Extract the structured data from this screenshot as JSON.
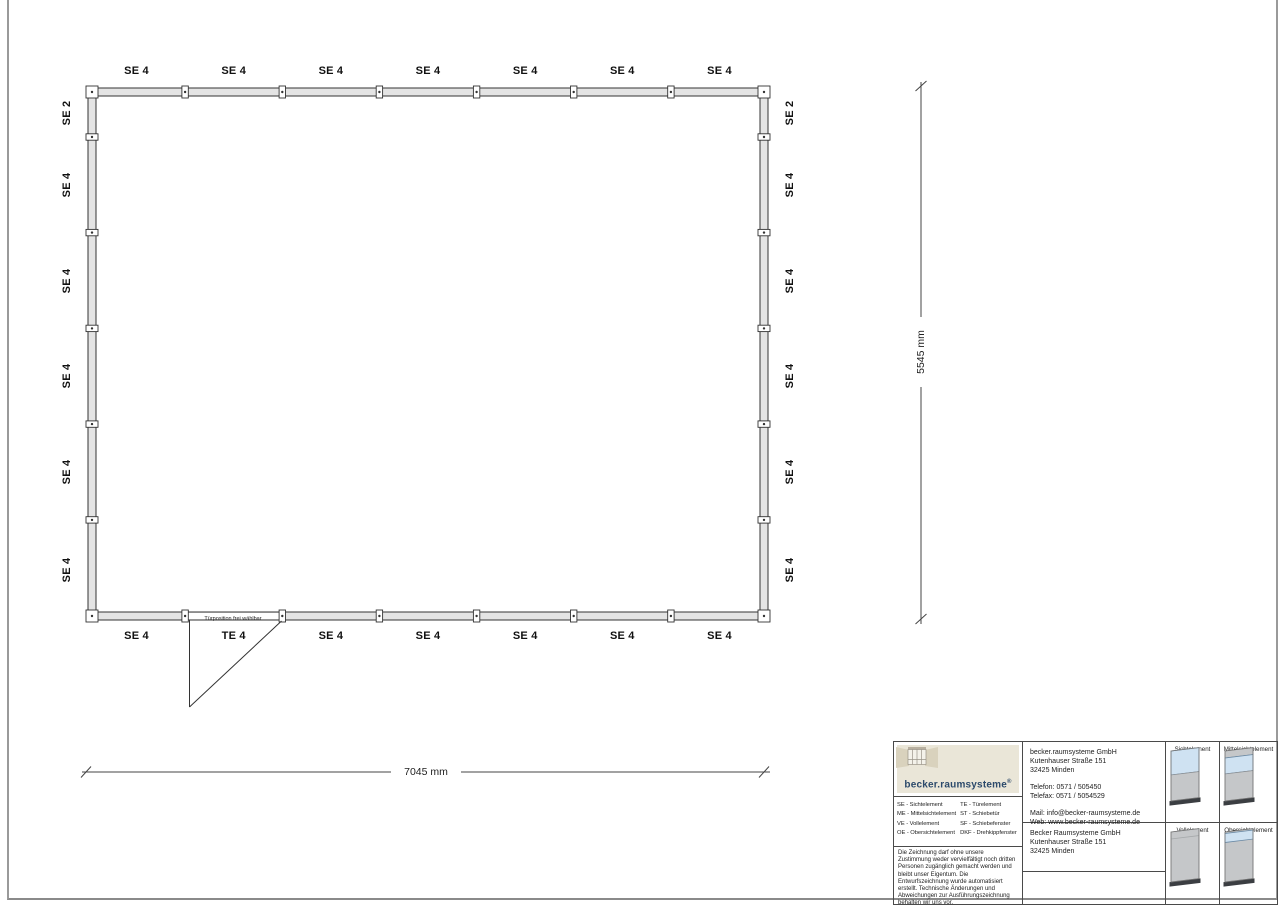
{
  "colors": {
    "glass": "#cfe2f2",
    "panel": "#c5c7c9",
    "panel_base": "#3b3e42",
    "logo_bg": "#eae6d8",
    "logo_text": "#2c4a6b"
  },
  "drawing": {
    "top_labels": [
      "SE 4",
      "SE 4",
      "SE 4",
      "SE 4",
      "SE 4",
      "SE 4",
      "SE 4"
    ],
    "bottom_labels": [
      "SE 4",
      "TE 4",
      "SE 4",
      "SE 4",
      "SE 4",
      "SE 4",
      "SE 4"
    ],
    "left_labels": [
      "SE 2",
      "SE 4",
      "SE 4",
      "SE 4",
      "SE 4",
      "SE 4"
    ],
    "right_labels": [
      "SE 2",
      "SE 4",
      "SE 4",
      "SE 4",
      "SE 4",
      "SE 4"
    ],
    "door_note": "Türposition frei wählbar",
    "width_dim": "7045 mm",
    "height_dim": "5545 mm"
  },
  "titleblock": {
    "logo": {
      "text": "becker.raumsysteme",
      "reg": "®"
    },
    "legend": {
      "col1": [
        "SE - Sichtelement",
        "ME - Mittelsichtelement",
        "VE - Vollelement",
        "OE - Obersichtelement"
      ],
      "col2": [
        "TE - Türelement",
        "ST - Schiebetür",
        "SF - Schiebefenster",
        "DKF - Drehkippfenster"
      ]
    },
    "disclaimer": "Die Zeichnung darf ohne unsere Zustimmung weder vervielfältigt noch dritten Personen zugänglich gemacht werden und bleibt unser Eigentum. Die Entwurfszeichnung wurde automatisiert erstellt. Technische Änderungen und Abweichungen zur Ausführungszeichnung behalten wir uns vor.",
    "contact": {
      "company": "becker.raumsysteme GmbH",
      "street": "Kutenhauser Straße 151",
      "city": "32425 Minden",
      "phone": "Telefon: 0571 / 505450",
      "fax": "Telefax: 0571 / 5054529",
      "mail": "Mail: info@becker-raumsysteme.de",
      "web": "Web: www.becker-raumsysteme.de"
    },
    "owner": {
      "company": "Becker Raumsysteme GmbH",
      "street": "Kutenhauser Straße 151",
      "city": "32425 Minden"
    },
    "element_labels": [
      "Sichtelement",
      "Mittelsichtelement",
      "Vollelement",
      "Obersichtelement"
    ]
  }
}
